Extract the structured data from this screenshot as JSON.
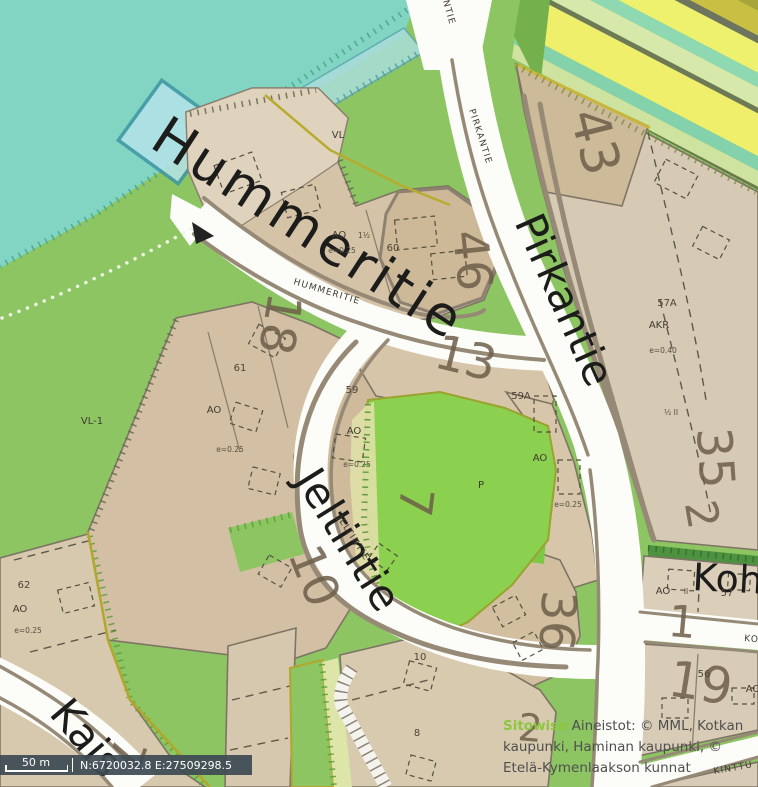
{
  "palette": {
    "water": "#82d5c2",
    "green_base": "#8cc561",
    "green_bright": "#8bd04e",
    "green_hedge_dark": "#4e9140",
    "tan_block": "#d6c5a8",
    "tan_dark": "#ccb997",
    "tan_light": "#e0d3bd",
    "road_white": "#fcfcf9",
    "stripe_yellow": "#f0ef6c",
    "stripe_mint": "#86d3ab",
    "stripe_olive": "#c9c043",
    "number_brown": "#6d5e4a",
    "street_text": "#1c1c1a",
    "chip_bg": "#3e4a54",
    "brand_green": "#8dc63f"
  },
  "status_bar": {
    "scale_label": "50 m",
    "coordinates": "N:6720032.8 E:27509298.5"
  },
  "attribution": {
    "brand": "Sitowise",
    "text": "Aineistot: © MML, Kotkan kaupunki, Haminan kaupunki, © Etelä-Kymenlaakson kunnat"
  },
  "streets_major": {
    "hummeritie": "Hummeritie",
    "pirkantie": "Pirkantie",
    "jeltintie": "Jeltintie",
    "koh": "Koh",
    "kais": "Kais"
  },
  "streets_minor": {
    "pirkantie": "PIRKANTIE",
    "hummeritie": "HUMMERITIE",
    "jeltintie": "JELTINTIE",
    "kinttu": "KINTTU",
    "ko": "KO"
  },
  "block_numbers": {
    "b43": "43",
    "b46": "46",
    "b18": "18",
    "b13": "13",
    "b35": "35",
    "b2_right": "2",
    "b7_center": "7",
    "b10": "10",
    "b36": "36",
    "b1": "1",
    "b19": "19",
    "b2_south": "2",
    "b7_southwest": "7"
  },
  "parcel_numbers": {
    "p60": "60",
    "p61": "61",
    "p59": "59",
    "p59a": "59A",
    "p57a": "57A",
    "p62": "62",
    "p56": "56",
    "p57": "57",
    "p10": "10",
    "p8": "8"
  },
  "zoning": {
    "vl": "VL",
    "vl1": "VL-1",
    "akr": "AKR",
    "p": "P",
    "ao": "AO",
    "e025": "e=0.25",
    "e040": "e=0.40",
    "one_half": "1½",
    "half_ii": "½ II",
    "ii": "II"
  }
}
